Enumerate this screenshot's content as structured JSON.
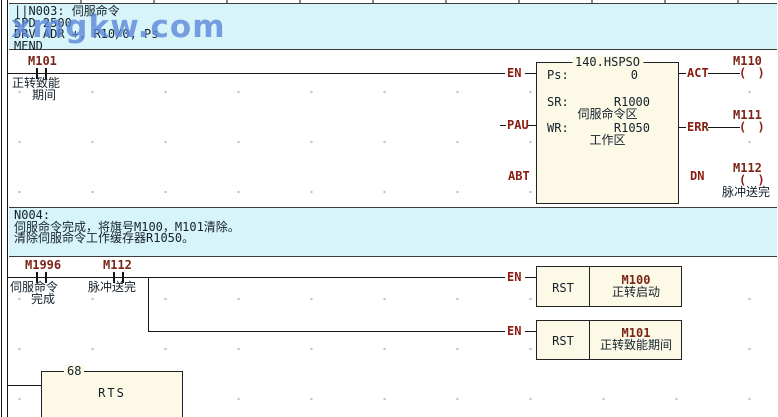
{
  "colors": {
    "band-bg": "#d7f4f8",
    "block-fill": "#fcf9e7",
    "device": "#7b2418",
    "pin": "#8b1d12",
    "wire": "#161616",
    "text": "#14212b",
    "watermark": "#5d87d9",
    "grid-dot": "#c2c2c2"
  },
  "watermark": {
    "text": "xmgkw.com"
  },
  "comments": {
    "n003": {
      "lines": [
        "||N003: 伺服命令",
        "SPD 2500",
        "DRV ADR +, R10/0, Ps",
        "MEND"
      ]
    },
    "n004": {
      "lines": [
        "N004:",
        "伺服命令完成，将旗号M100，M101清除。",
        "清除伺服命令工作缓存器R1050。"
      ]
    }
  },
  "rung1": {
    "contact": {
      "device": "M101",
      "comment1": "正转致能",
      "comment2": "期间"
    },
    "fb": {
      "title": "140.HSPSO",
      "params": [
        {
          "label": "Ps:",
          "value": "0",
          "comment": ""
        },
        {
          "label": "SR:",
          "value": "R1000",
          "comment": "伺服命令区"
        },
        {
          "label": "WR:",
          "value": "R1050",
          "comment": "工作区"
        }
      ],
      "pins_left": [
        "EN",
        "PAU",
        "ABT"
      ],
      "pins_right": [
        "ACT",
        "ERR",
        "DN"
      ]
    },
    "coils": [
      {
        "device": "M110",
        "symbol": "( )",
        "comment": ""
      },
      {
        "device": "M111",
        "symbol": "( )",
        "comment": ""
      },
      {
        "device": "M112",
        "symbol": "( )",
        "comment": "脉冲送完"
      }
    ]
  },
  "rung2": {
    "contacts": [
      {
        "device": "M1996",
        "comment1": "伺服命令",
        "comment2": "完成"
      },
      {
        "device": "M112",
        "comment1": "脉冲送完",
        "comment2": ""
      }
    ],
    "pin_en": "EN",
    "rst": [
      {
        "op": "RST",
        "device": "M100",
        "comment": "正转启动"
      },
      {
        "op": "RST",
        "device": "M101",
        "comment": "正转致能期间"
      }
    ]
  },
  "rung3": {
    "step": "68",
    "op": "RTS"
  }
}
